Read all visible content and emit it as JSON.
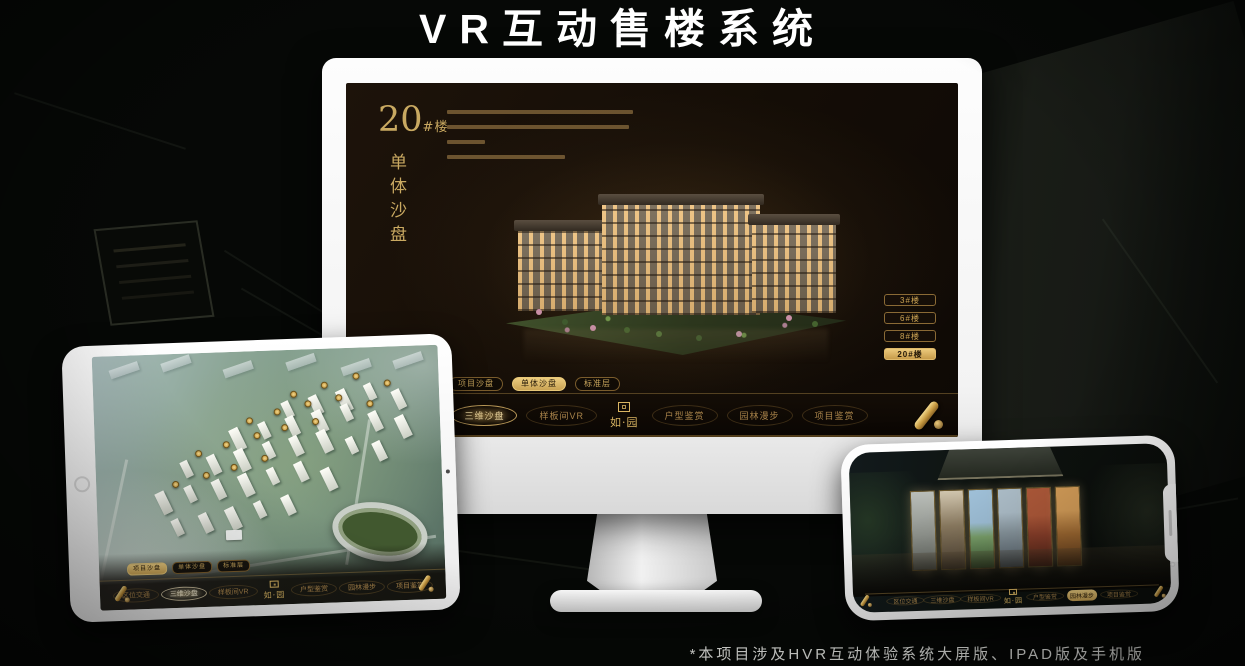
{
  "page": {
    "title": "VR互动售楼系统",
    "footnote": "*本项目涉及HVR互动体验系统大屏版、IPAD版及手机版"
  },
  "colors": {
    "gold": "#c9a253",
    "gold_bright": "#ecd9a6",
    "screen_bg": "#140d06",
    "device_white": "#ffffff"
  },
  "monitor": {
    "heading": {
      "number": "20",
      "suffix": "#楼",
      "vertical": "单体沙盘"
    },
    "building_buttons": [
      {
        "label": "3#楼",
        "active": false
      },
      {
        "label": "6#楼",
        "active": false
      },
      {
        "label": "8#楼",
        "active": false
      },
      {
        "label": "20#楼",
        "active": true
      }
    ],
    "subtabs": [
      {
        "label": "项目沙盘",
        "active": false
      },
      {
        "label": "单体沙盘",
        "active": true
      },
      {
        "label": "标准层",
        "active": false
      }
    ],
    "nav_items": [
      {
        "label": "区位交通",
        "active": false
      },
      {
        "label": "三维沙盘",
        "active": true
      },
      {
        "label": "样板间VR",
        "active": false
      },
      {
        "label": "户型鉴赏",
        "active": false
      },
      {
        "label": "园林漫步",
        "active": false
      },
      {
        "label": "项目鉴赏",
        "active": false
      }
    ],
    "logo": "如·园"
  },
  "tablet": {
    "subtabs": [
      {
        "label": "项目沙盘",
        "active": true
      },
      {
        "label": "单体沙盘",
        "active": false
      },
      {
        "label": "标准层",
        "active": false
      }
    ],
    "nav_items": [
      {
        "label": "区位交通",
        "active": false
      },
      {
        "label": "三维沙盘",
        "active": true
      },
      {
        "label": "样板间VR",
        "active": false
      },
      {
        "label": "户型鉴赏",
        "active": false
      },
      {
        "label": "园林漫步",
        "active": false
      },
      {
        "label": "项目鉴赏",
        "active": false
      }
    ],
    "logo": "如·园"
  },
  "phone": {
    "nav_items": [
      {
        "label": "区位交通",
        "active": false
      },
      {
        "label": "三维沙盘",
        "active": false
      },
      {
        "label": "样板间VR",
        "active": false
      },
      {
        "label": "户型鉴赏",
        "active": false
      },
      {
        "label": "园林漫步",
        "active": true
      },
      {
        "label": "项目鉴赏",
        "active": false
      }
    ],
    "logo": "如·园"
  }
}
